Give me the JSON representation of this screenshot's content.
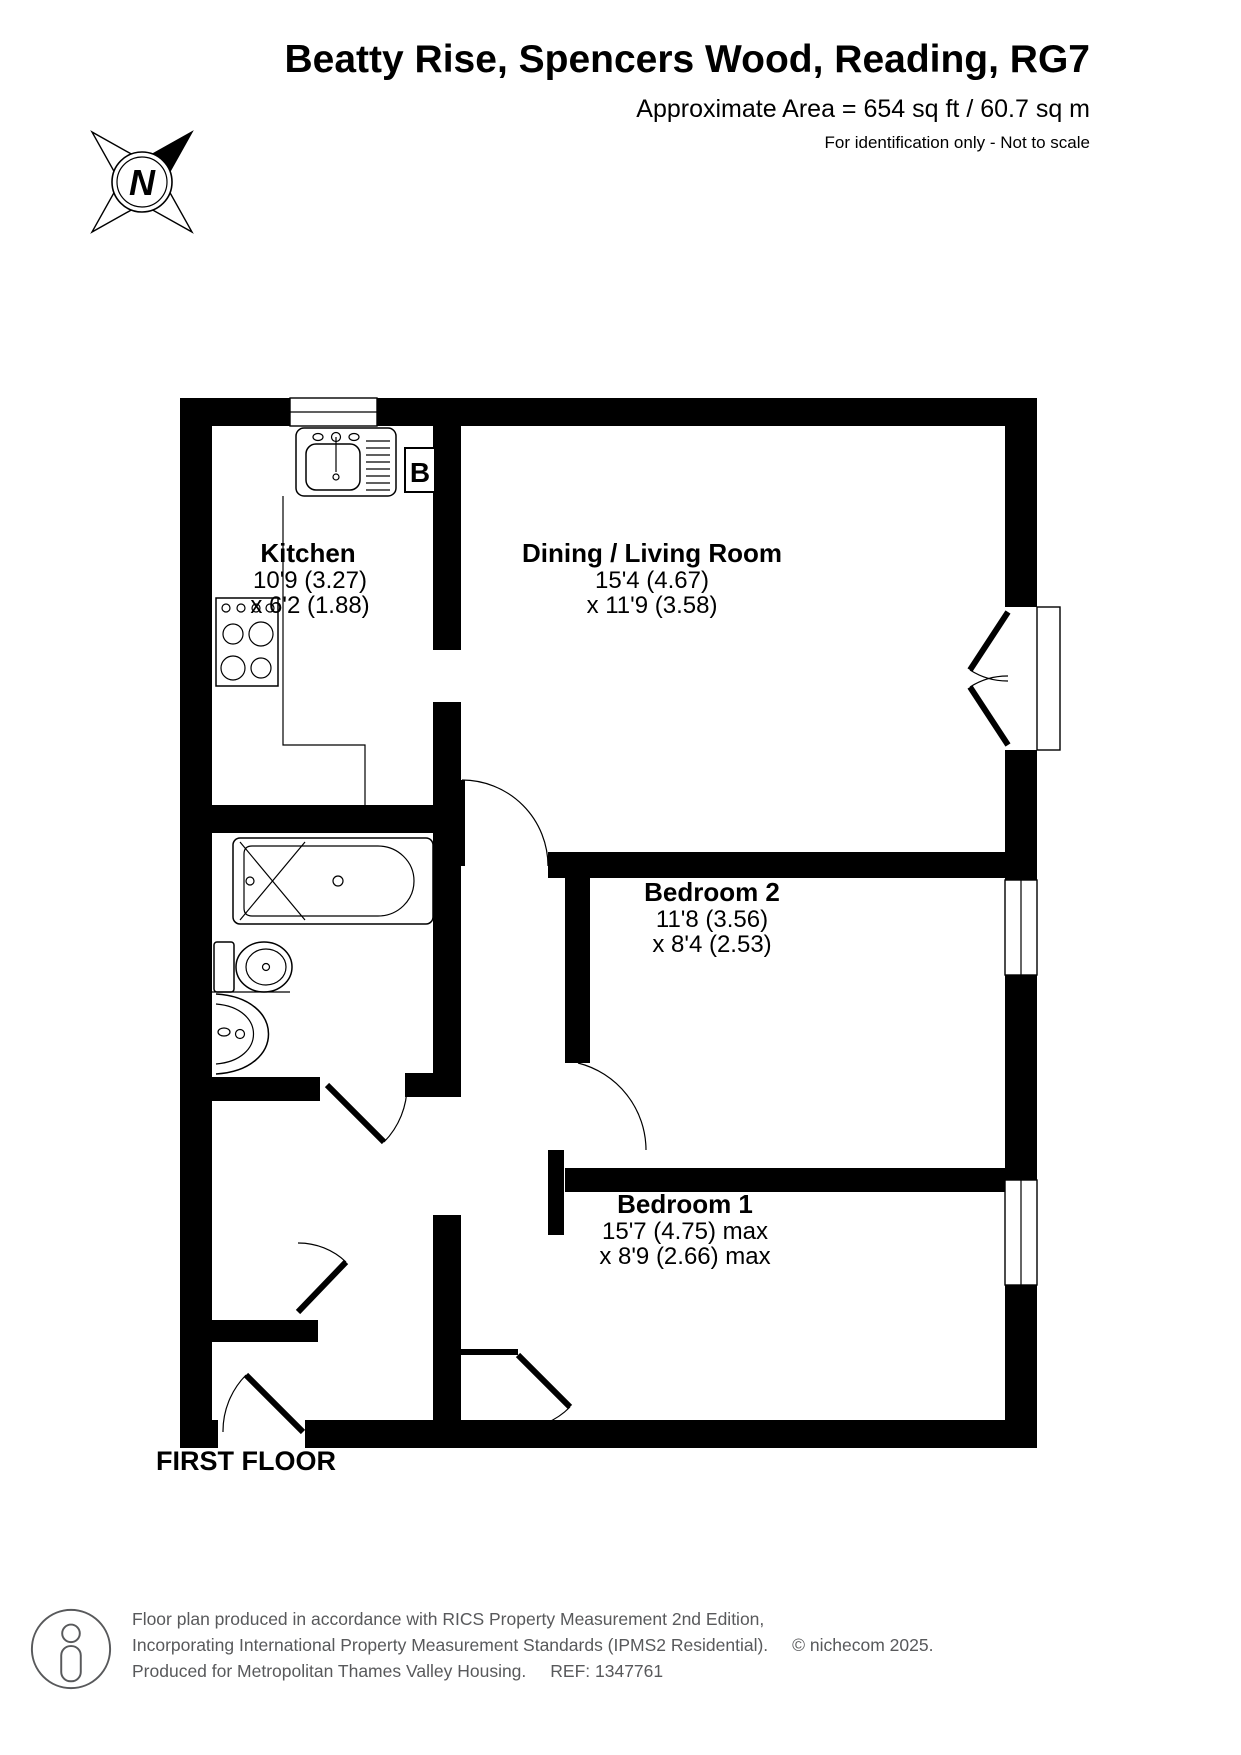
{
  "header": {
    "title": "Beatty Rise, Spencers Wood, Reading, RG7",
    "area": "Approximate Area = 654 sq ft / 60.7 sq m",
    "note": "For identification only - Not to scale"
  },
  "compass": {
    "north_label": "N"
  },
  "floor_label": "FIRST FLOOR",
  "rooms": [
    {
      "name": "Kitchen",
      "dim1": "10'9 (3.27)",
      "dim2": "x 6'2 (1.88)"
    },
    {
      "name": "Dining / Living Room",
      "dim1": "15'4 (4.67)",
      "dim2": "x 11'9 (3.58)"
    },
    {
      "name": "Bedroom 2",
      "dim1": "11'8 (3.56)",
      "dim2": "x 8'4 (2.53)"
    },
    {
      "name": "Bedroom 1",
      "dim1": "15'7 (4.75) max",
      "dim2": "x 8'9 (2.66) max"
    }
  ],
  "labels": {
    "boiler": "B"
  },
  "icons": {
    "compass": "compass-north-icon",
    "logo": "person-outline-icon"
  },
  "colors": {
    "wall": "#000000",
    "footer_text": "#58595b",
    "background": "#ffffff"
  },
  "footer": {
    "line1": "Floor plan produced in accordance with RICS Property Measurement 2nd Edition,",
    "line2": "Incorporating International Property Measurement Standards (IPMS2 Residential).",
    "copyright": "© nichecom 2025.",
    "line3": "Produced for Metropolitan Thames Valley Housing.",
    "ref": "REF: 1347761"
  }
}
